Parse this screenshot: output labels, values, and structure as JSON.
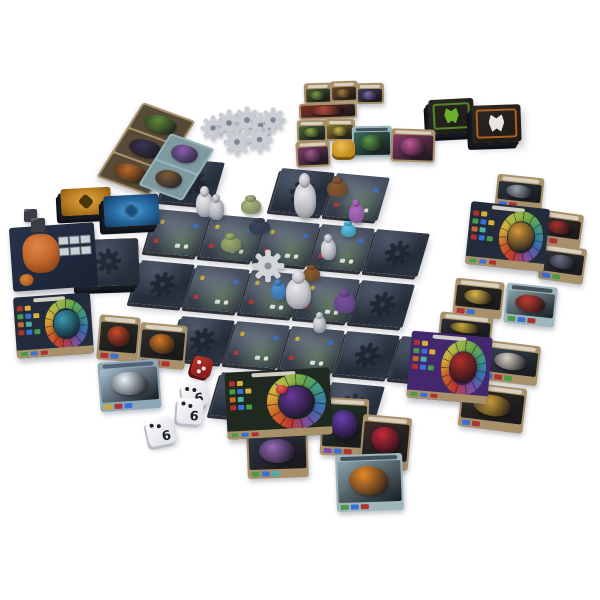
{
  "scene": {
    "description": "Tabletop product photo of a dungeon-crawler board game fully set up on white background",
    "background": "#ffffff"
  },
  "palette": {
    "tile_facedown": "#2c3340",
    "tile_revealed": "#3a424f",
    "card_frame": "#a8916a",
    "teal_card": "#9fb6bd",
    "gear_token": "#caced4",
    "board_navy": "#242b3a",
    "board_purple": "#43286e",
    "board_boss_green": "#20291f",
    "accent_red": "#c23a2e",
    "accent_gold": "#d8a83a",
    "accent_blue": "#3a6fb0"
  },
  "board": {
    "origin": {
      "x": 172,
      "y": 158
    },
    "axis_u": {
      "x": 55,
      "y": 5
    },
    "axis_v": {
      "x": -15,
      "y": 51
    },
    "tile_w": 53,
    "tile_h": 43,
    "rows": [
      "D.DR..",
      "RRRRD.",
      "DRRRD.",
      ".DRRDD",
      "..DDD."
    ]
  },
  "gear_cluster": [
    {
      "name": "gear-token",
      "x": 200,
      "y": 115,
      "s": 26
    },
    {
      "name": "gear-token",
      "x": 215,
      "y": 109,
      "s": 28
    },
    {
      "name": "gear-token",
      "x": 233,
      "y": 106,
      "s": 28
    },
    {
      "name": "gear-token",
      "x": 247,
      "y": 112,
      "s": 27
    },
    {
      "name": "gear-token",
      "x": 260,
      "y": 107,
      "s": 26
    },
    {
      "name": "gear-token",
      "x": 223,
      "y": 128,
      "s": 28
    },
    {
      "name": "gear-token",
      "x": 246,
      "y": 126,
      "s": 27
    }
  ],
  "gear_on_board": {
    "name": "gear-token-on-tile",
    "x": 251,
    "y": 249,
    "s": 34
  },
  "strips": [
    {
      "name": "monster-card-strip-brown",
      "x": 118,
      "y": 106,
      "w": 56,
      "h": 86,
      "rot": 20,
      "skew": -12,
      "style": "brown",
      "faces": [
        "#5f8a3a",
        "#3a3550",
        "#b96a2c"
      ]
    },
    {
      "name": "monster-card-strip-teal",
      "x": 153,
      "y": 137,
      "w": 47,
      "h": 60,
      "rot": 20,
      "skew": -12,
      "style": "teal",
      "faces": [
        "#8a5fb0",
        "#7a5a38"
      ]
    }
  ],
  "decks": [
    {
      "name": "deck-gold",
      "x": 61,
      "y": 188,
      "w": 50,
      "h": 27,
      "rot": -3,
      "style": "gold"
    },
    {
      "name": "deck-blue",
      "x": 104,
      "y": 195,
      "w": 55,
      "h": 31,
      "rot": -3,
      "style": "blue"
    },
    {
      "name": "deck-dungeon-tiles",
      "x": 78,
      "y": 239,
      "w": 61,
      "h": 47,
      "rot": -2,
      "style": "navy",
      "emblem": true
    },
    {
      "name": "deck-green-monsters",
      "x": 429,
      "y": 99,
      "w": 45,
      "h": 34,
      "rot": -3,
      "style": "framed",
      "frame": "#5a9a2c",
      "icon": "#6ab02f"
    },
    {
      "name": "deck-orange-monsters",
      "x": 472,
      "y": 105,
      "w": 49,
      "h": 37,
      "rot": -2,
      "style": "framed",
      "frame": "#c56a22",
      "icon": "#e8e6e0"
    }
  ],
  "robot_board": {
    "name": "forge-robot-board",
    "x": 11,
    "y": 225,
    "w": 85,
    "h": 64,
    "rot": -4
  },
  "market_cards": [
    {
      "name": "market-card",
      "x": 304,
      "y": 83,
      "w": 28,
      "h": 21,
      "rot": -2,
      "art": "#4a5a38",
      "blob": "#7a9a4a"
    },
    {
      "name": "market-card",
      "x": 330,
      "y": 81,
      "w": 28,
      "h": 21,
      "rot": -2,
      "art": "#6b4a2f",
      "blob": "#a87a3a"
    },
    {
      "name": "market-card",
      "x": 356,
      "y": 83,
      "w": 28,
      "h": 21,
      "rot": -1,
      "art": "#41395a",
      "blob": "#7a6aa8"
    },
    {
      "name": "market-card-wide",
      "x": 299,
      "y": 103,
      "w": 58,
      "h": 16,
      "rot": -2,
      "art": "#7a3026",
      "blob": "#b04a3a",
      "nobanner": true
    },
    {
      "name": "market-card",
      "x": 297,
      "y": 120,
      "w": 30,
      "h": 22,
      "rot": -1,
      "art": "#49683a",
      "blob": "#8aa84a"
    },
    {
      "name": "market-card",
      "x": 325,
      "y": 119,
      "w": 30,
      "h": 22,
      "rot": 0,
      "art": "#8a7a30",
      "blob": "#c8b44a"
    },
    {
      "name": "market-card",
      "x": 296,
      "y": 141,
      "w": 34,
      "h": 26,
      "rot": -3,
      "art": "#7a3a68",
      "blob": "#a05a8a"
    },
    {
      "name": "market-card-teal-monster",
      "x": 352,
      "y": 126,
      "w": 40,
      "h": 31,
      "rot": -1,
      "style": "teal",
      "art": "#3a6a58",
      "blob": "#5a9a4a"
    },
    {
      "name": "market-card-pink-monster",
      "x": 391,
      "y": 129,
      "w": 44,
      "h": 33,
      "rot": 2,
      "art": "#8a3a66",
      "blob": "#c05898"
    }
  ],
  "item_cards": [
    {
      "name": "item-card-fish-blade",
      "x": 496,
      "y": 176,
      "w": 47,
      "h": 34,
      "rot": 6,
      "art": "#2e3642",
      "blob": "#9aa3ae",
      "chips": [
        "#3a6fd8",
        "#b03230"
      ]
    },
    {
      "name": "item-card-axe",
      "x": 537,
      "y": 212,
      "w": 45,
      "h": 34,
      "rot": 8,
      "art": "#33302c",
      "blob": "#a8322c",
      "chips": [
        "#3a6fd8",
        "#b03230"
      ]
    },
    {
      "name": "item-card-dark-sword",
      "x": 540,
      "y": 246,
      "w": 45,
      "h": 36,
      "rot": 8,
      "art": "#2c3138",
      "blob": "#6a7282",
      "chips": [
        "#3a6fd8",
        "#4a9a4a"
      ]
    },
    {
      "name": "item-card-gold-sword",
      "x": 454,
      "y": 280,
      "w": 49,
      "h": 37,
      "rot": 6,
      "art": "#2e2a22",
      "blob": "#d8b44a",
      "chips": [
        "#b03230",
        "#3a6fd8"
      ]
    },
    {
      "name": "item-card-gold-blue",
      "x": 439,
      "y": 314,
      "w": 53,
      "h": 31,
      "rot": 6,
      "art": "#2a2e38",
      "blob": "#c8a83a",
      "chips": [
        "#b03230",
        "#3a6fd8"
      ]
    },
    {
      "name": "item-card-feather",
      "x": 482,
      "y": 343,
      "w": 57,
      "h": 40,
      "rot": 7,
      "art": "#3a4252",
      "blob": "#d8d2c4",
      "chips": [
        "#3a6fd8",
        "#b03230",
        "#4a9a4a"
      ]
    },
    {
      "name": "item-card-gold-hammer",
      "x": 460,
      "y": 385,
      "w": 65,
      "h": 45,
      "rot": 7,
      "art": "#2e2a20",
      "blob": "#d8a83a",
      "chips": [
        "#3a6fd8",
        "#b03230"
      ]
    },
    {
      "name": "item-card-purple-dragon",
      "x": 321,
      "y": 398,
      "w": 47,
      "h": 58,
      "rot": 3,
      "art": "#243528",
      "blob": "#6a3fb0",
      "chips": [
        "#7a4fa0",
        "#3a6fd8",
        "#b03230"
      ]
    },
    {
      "name": "item-card-red-crystal-beast",
      "x": 361,
      "y": 416,
      "w": 49,
      "h": 53,
      "rot": 5,
      "art": "#3a2a28",
      "blob": "#c82a3c",
      "chips": [
        "#b03230"
      ]
    },
    {
      "name": "item-card-long-rex",
      "x": 247,
      "y": 428,
      "w": 61,
      "h": 50,
      "rot": -2,
      "art": "#2e3440",
      "blob": "#9a6ab8",
      "chips": [
        "#4a9a4a",
        "#3a6fd8",
        "#4ab0a0"
      ]
    },
    {
      "name": "item-card-phoenix",
      "x": 98,
      "y": 316,
      "w": 41,
      "h": 45,
      "rot": 5,
      "art": "#2e3028",
      "blob": "#c84a28",
      "chips": [
        "#b03230",
        "#3a6fd8"
      ]
    },
    {
      "name": "item-card-flame-whip",
      "x": 139,
      "y": 324,
      "w": 47,
      "h": 44,
      "rot": 5,
      "art": "#2a2e2a",
      "blob": "#d87a28",
      "chips": [
        "#3a6fd8",
        "#b03230",
        "#b03230"
      ]
    }
  ],
  "ability_cards": [
    {
      "name": "ability-card-meat",
      "x": 505,
      "y": 285,
      "w": 51,
      "h": 40,
      "rot": 6,
      "style": "teal",
      "art": "#8aa4ab",
      "blob": "#c03a32",
      "chips": [
        "#4a9a4a",
        "#3a6fd8",
        "#b03230"
      ]
    },
    {
      "name": "ability-card-flame-lion",
      "x": 336,
      "y": 454,
      "w": 67,
      "h": 57,
      "rot": -2,
      "style": "teal",
      "art": "#8aa4ab",
      "blob": "#e8882a",
      "chips": [
        "#4a9a4a",
        "#3a6fd8",
        "#b03230"
      ]
    },
    {
      "name": "ability-card-lightning",
      "x": 99,
      "y": 361,
      "w": 61,
      "h": 49,
      "rot": -4,
      "style": "bluegray",
      "art": "#a8c0d0",
      "blob": "#e8f2fa",
      "chips": [
        "#c8a83a",
        "#b03230",
        "#3a6fd8"
      ]
    }
  ],
  "player_boards": [
    {
      "name": "player-board-yellow-hero",
      "x": 468,
      "y": 205,
      "w": 79,
      "h": 63,
      "rot": 6,
      "bg": "#242b3a",
      "char": "#d89a3a"
    },
    {
      "name": "player-board-red-demon",
      "x": 409,
      "y": 334,
      "w": 81,
      "h": 67,
      "rot": 5,
      "bg": "#43286e",
      "char": "#b03028"
    },
    {
      "name": "boss-board-purple-dragon",
      "x": 226,
      "y": 370,
      "w": 105,
      "h": 67,
      "rot": -3,
      "bg": "#20291f",
      "char": "#6a3a9a"
    },
    {
      "name": "player-board-blue-hero",
      "x": 15,
      "y": 295,
      "w": 77,
      "h": 61,
      "rot": -4,
      "bg": "#222c3c",
      "char": "#3a9ab0"
    }
  ],
  "minis": [
    {
      "name": "mini-hero-white",
      "x": 196,
      "y": 192,
      "w": 17,
      "h": 25,
      "c": "#ebebee",
      "plastic": true
    },
    {
      "name": "mini-hero-white",
      "x": 209,
      "y": 199,
      "w": 15,
      "h": 21,
      "c": "#dddde3",
      "plastic": true
    },
    {
      "name": "mini-monster-green",
      "x": 241,
      "y": 199,
      "w": 20,
      "h": 15,
      "c": "#a9b87c"
    },
    {
      "name": "mini-monster-dark",
      "x": 249,
      "y": 221,
      "w": 21,
      "h": 13,
      "c": "#3d4358"
    },
    {
      "name": "mini-monster-green",
      "x": 221,
      "y": 237,
      "w": 20,
      "h": 15,
      "c": "#9fae6e"
    },
    {
      "name": "mini-hero-white-large",
      "x": 294,
      "y": 182,
      "w": 22,
      "h": 36,
      "c": "#e8e8ec",
      "plastic": true
    },
    {
      "name": "token-bear-brown",
      "x": 327,
      "y": 181,
      "w": 21,
      "h": 16,
      "c": "#8a5a2f"
    },
    {
      "name": "mini-monster-purple",
      "x": 349,
      "y": 204,
      "w": 15,
      "h": 19,
      "c": "#b06cc4"
    },
    {
      "name": "token-crystal-blue",
      "x": 341,
      "y": 224,
      "w": 15,
      "h": 13,
      "c": "#55c4e6"
    },
    {
      "name": "mini-hero-white",
      "x": 321,
      "y": 239,
      "w": 15,
      "h": 21,
      "c": "#e3e3e9",
      "plastic": true
    },
    {
      "name": "token-beast-brown",
      "x": 303,
      "y": 268,
      "w": 17,
      "h": 13,
      "c": "#8a5a2a"
    },
    {
      "name": "mini-monster-blue",
      "x": 271,
      "y": 283,
      "w": 15,
      "h": 17,
      "c": "#4a8fd4"
    },
    {
      "name": "mini-hero-white-rat",
      "x": 286,
      "y": 278,
      "w": 25,
      "h": 31,
      "c": "#eaeaee",
      "plastic": true
    },
    {
      "name": "mini-monster-purple-crystal",
      "x": 334,
      "y": 294,
      "w": 21,
      "h": 19,
      "c": "#7a4fa0"
    },
    {
      "name": "mini-hero-white",
      "x": 313,
      "y": 316,
      "w": 13,
      "h": 17,
      "c": "#e0e1e7",
      "plastic": true
    }
  ],
  "tokens": [
    {
      "name": "gold-token-stack",
      "kind": "goldtok",
      "x": 332,
      "y": 140,
      "w": 23,
      "h": 17
    },
    {
      "name": "gray-cube",
      "kind": "cube",
      "x": 24,
      "y": 209,
      "w": 13,
      "h": 13
    },
    {
      "name": "gray-cube",
      "kind": "cube",
      "x": 31,
      "y": 218,
      "w": 14,
      "h": 14
    },
    {
      "name": "red-gem-token",
      "kind": "gemred",
      "x": 276,
      "y": 385,
      "w": 11,
      "h": 9
    }
  ],
  "dice": [
    {
      "name": "die-red",
      "x": 192,
      "y": 357,
      "s": 20,
      "rot": 15,
      "value": "",
      "red": true
    },
    {
      "name": "die-white",
      "x": 182,
      "y": 382,
      "s": 25,
      "rot": -8,
      "value": "6"
    },
    {
      "name": "die-white",
      "x": 177,
      "y": 398,
      "s": 26,
      "rot": 4,
      "value": "6"
    },
    {
      "name": "die-white",
      "x": 147,
      "y": 418,
      "s": 27,
      "rot": -12,
      "value": "6"
    }
  ]
}
